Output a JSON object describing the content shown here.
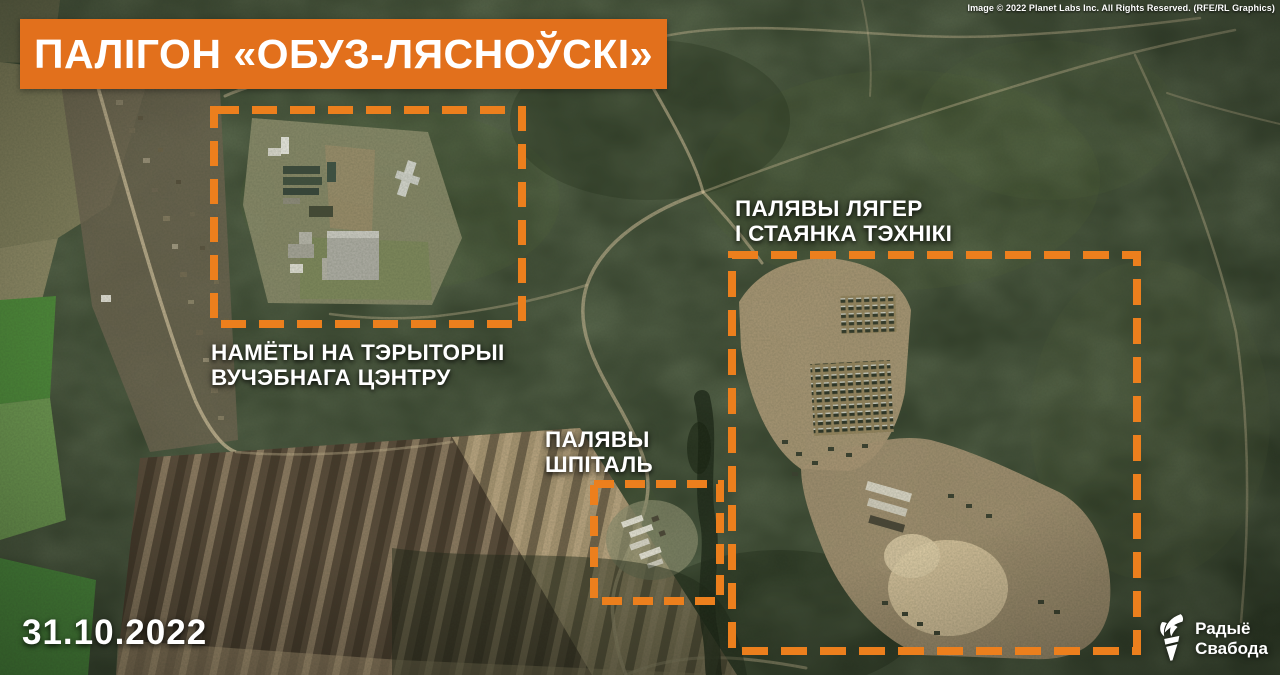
{
  "header": {
    "title": "ПАЛІГОН «ОБУЗ-ЛЯСНОЎСКІ»",
    "credit": "Image © 2022 Planet Labs Inc. All Rights Reserved. (RFE/RL Graphics)"
  },
  "annotations": [
    {
      "id": "training-center",
      "label": "НАМЁТЫ НА ТЭРЫТОРЫІ\nВУЧЭБНАГА ЦЭНТРУ"
    },
    {
      "id": "field-camp",
      "label": "ПАЛЯВЫ ЛЯГЕР\nІ СТАЯНКА ТЭХНІКІ"
    },
    {
      "id": "field-hospital",
      "label": "ПАЛЯВЫ\nШПІТАЛЬ"
    }
  ],
  "date_label": "31.10.2022",
  "logo": {
    "line1": "Радыё",
    "line2": "Свабода",
    "icon": "torch-icon"
  },
  "colors": {
    "accent_orange": "#EC7F1D",
    "banner_orange": "#E2701C",
    "label_white": "#FFFFFF"
  }
}
